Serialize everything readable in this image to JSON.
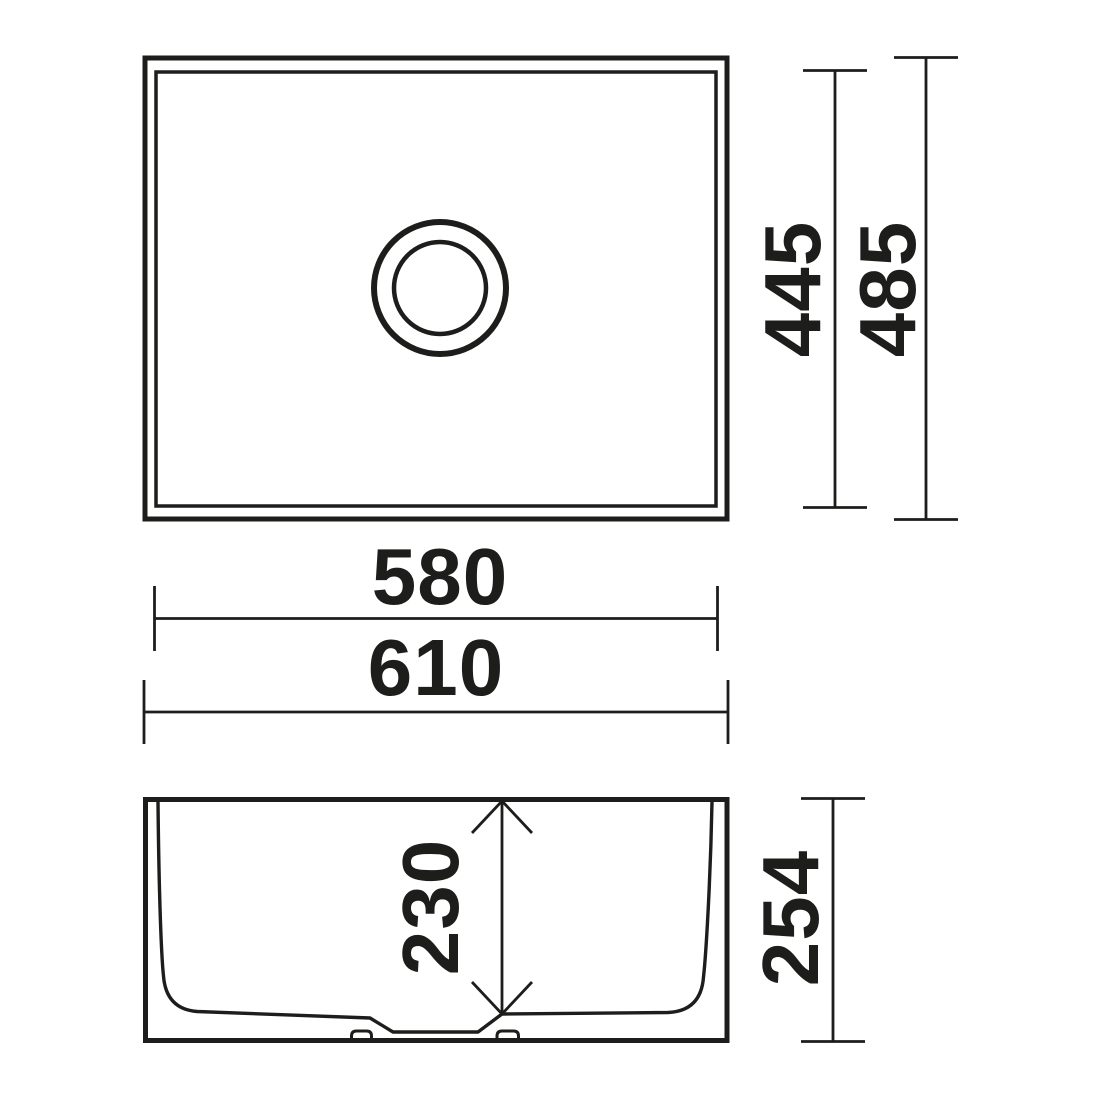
{
  "drawing": {
    "background_color": "#ffffff",
    "line_color": "#1d1d1b",
    "plan_view": {
      "inner_width_label": "580",
      "outer_width_label": "610",
      "inner_height_label": "445",
      "outer_height_label": "485"
    },
    "side_view": {
      "bowl_depth_label": "230",
      "overall_height_label": "254"
    }
  }
}
